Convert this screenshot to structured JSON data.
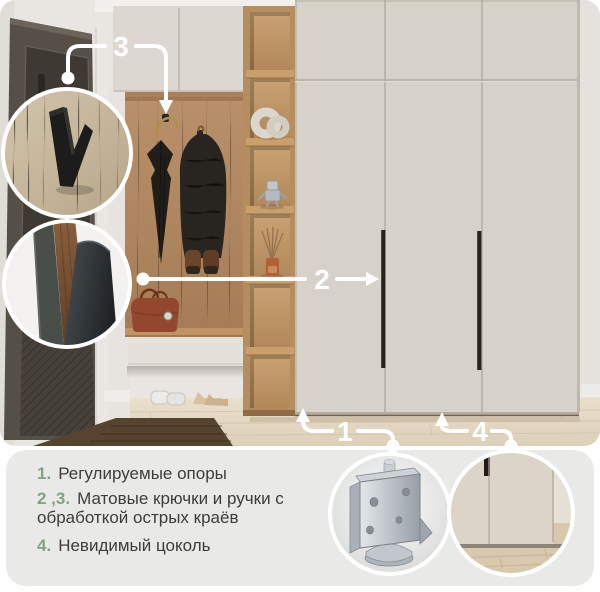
{
  "callouts": {
    "c1": {
      "label": "1",
      "points_at": "adjustable supports under cabinet base"
    },
    "c2": {
      "label": "2",
      "points_at": "wardrobe door handle"
    },
    "c3": {
      "label": "3",
      "points_at": "matte coat hook"
    },
    "c4": {
      "label": "4",
      "points_at": "invisible plinth at wardrobe bottom"
    }
  },
  "features": [
    {
      "number": "1.",
      "lines": [
        "Регулируемые опоры"
      ]
    },
    {
      "number": "2 ,3.",
      "lines": [
        "Матовые крючки и ручки с",
        "обработкой острых краёв"
      ]
    },
    {
      "number": "4.",
      "lines": [
        "Невидимый цоколь"
      ]
    }
  ],
  "insets": {
    "hook": "black V-shaped coat hook on oak panel",
    "handle": "matte handle edge close-up",
    "caster": "metal adjustable support foot",
    "plinth": "wardrobe bottom with invisible plinth"
  },
  "colors": {
    "accent_green": "#82a383",
    "panel_bg": "#e9eae8",
    "text": "#3c3c3c",
    "callout_white": "#ffffff",
    "wardrobe_cream": "#d6d1c9",
    "oak_wood": "#b68d5e"
  }
}
